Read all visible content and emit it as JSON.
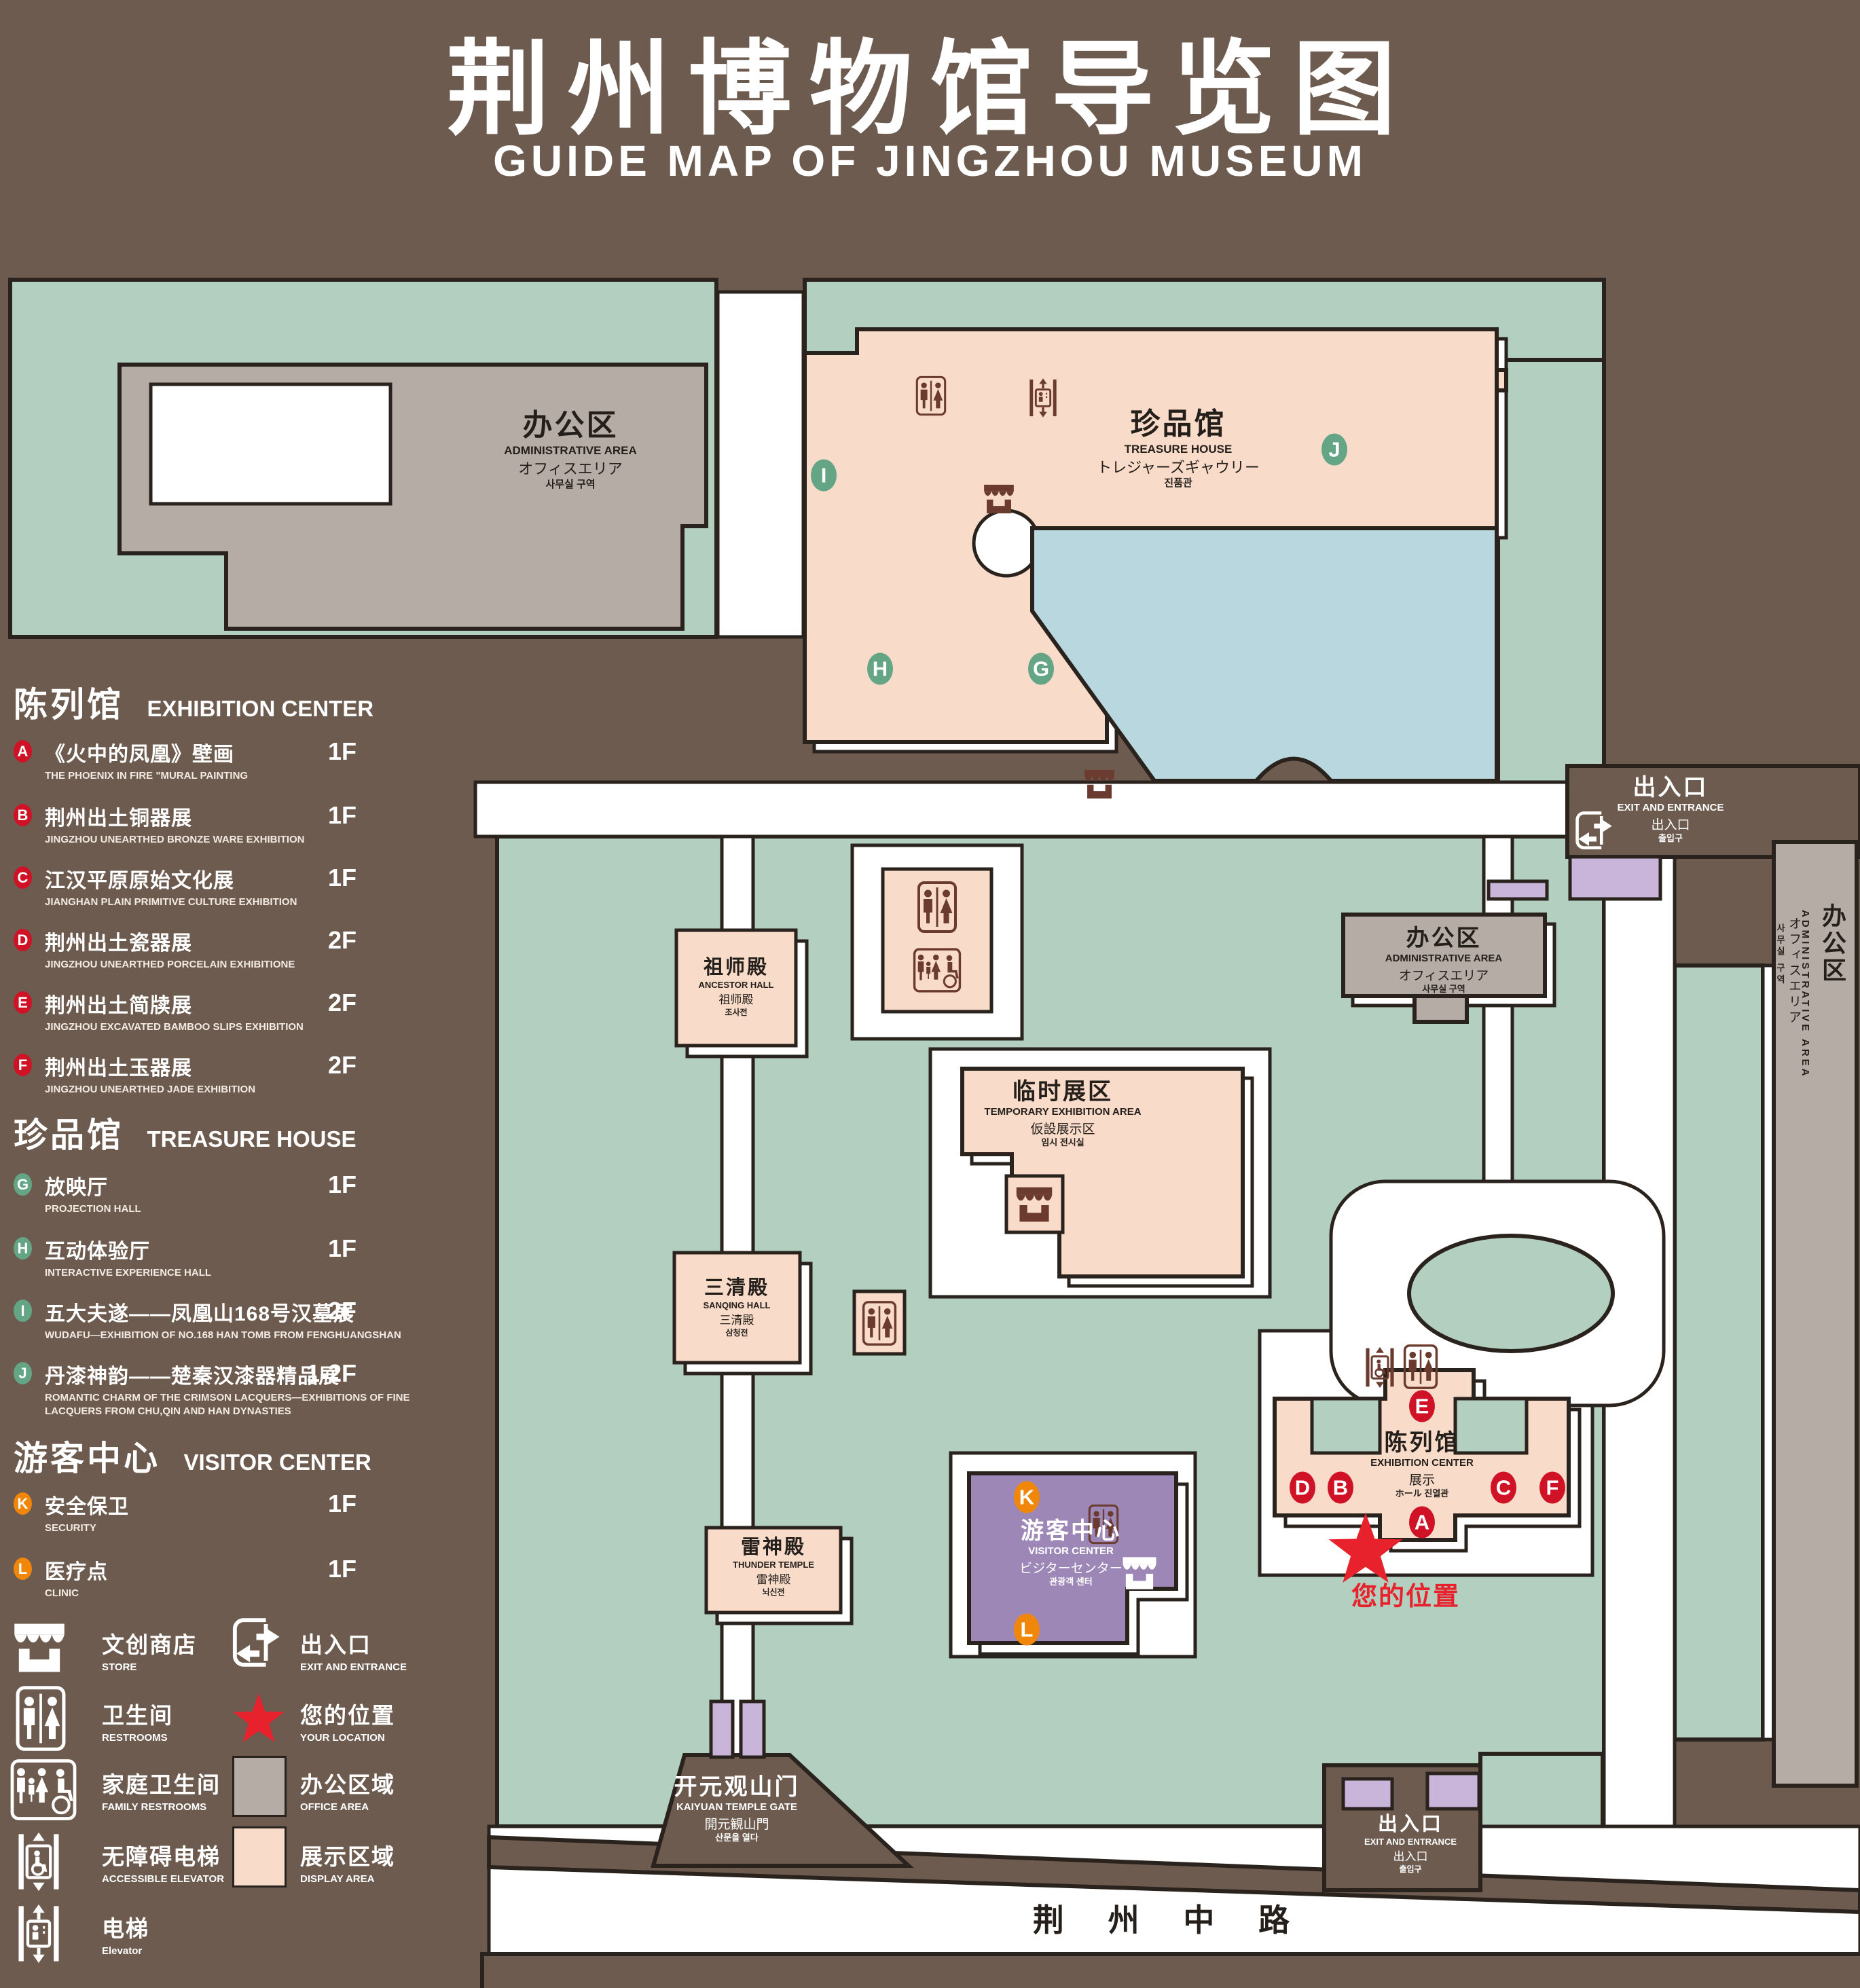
{
  "title": {
    "zh": "荆州博物馆导览图",
    "en": "GUIDE MAP OF JINGZHOU MUSEUM"
  },
  "colors": {
    "background": "#6d5b4f",
    "green_area": "#b3cfc0",
    "display_area": "#f9dbc9",
    "office_area": "#b5aca6",
    "visitor_center": "#9c87b7",
    "gate_accent": "#c8b5d9",
    "water": "#b9d7de",
    "outline": "#2a221d",
    "marker_red": "#cf1225",
    "marker_green": "#63a585",
    "marker_orange": "#f0860a",
    "location_red": "#e8222d"
  },
  "legend": {
    "sections": [
      {
        "zh": "陈列馆",
        "en": "EXHIBITION CENTER",
        "items": [
          {
            "id": "A",
            "zh": "《火中的凤凰》壁画",
            "en": "THE PHOENIX IN FIRE \"MURAL PAINTING",
            "floor": "1F"
          },
          {
            "id": "B",
            "zh": "荆州出土铜器展",
            "en": "JINGZHOU UNEARTHED BRONZE WARE EXHIBITION",
            "floor": "1F"
          },
          {
            "id": "C",
            "zh": "江汉平原原始文化展",
            "en": "JIANGHAN PLAIN PRIMITIVE CULTURE EXHIBITION",
            "floor": "1F"
          },
          {
            "id": "D",
            "zh": "荆州出土瓷器展",
            "en": "JINGZHOU UNEARTHED PORCELAIN EXHIBITIONE",
            "floor": "2F"
          },
          {
            "id": "E",
            "zh": "荆州出土简牍展",
            "en": "JINGZHOU EXCAVATED BAMBOO SLIPS EXHIBITION",
            "floor": "2F"
          },
          {
            "id": "F",
            "zh": "荆州出土玉器展",
            "en": "JINGZHOU UNEARTHED JADE EXHIBITION",
            "floor": "2F"
          }
        ]
      },
      {
        "zh": "珍品馆",
        "en": "TREASURE HOUSE",
        "items": [
          {
            "id": "G",
            "zh": "放映厅",
            "en": "PROJECTION HALL",
            "floor": "1F"
          },
          {
            "id": "H",
            "zh": "互动体验厅",
            "en": "INTERACTIVE EXPERIENCE HALL",
            "floor": "1F"
          },
          {
            "id": "I",
            "zh": "五大夫遂——凤凰山168号汉墓展",
            "en": "WUDAFU—EXHIBITION OF NO.168 HAN TOMB FROM FENGHUANGSHAN",
            "floor": "2F"
          },
          {
            "id": "J",
            "zh": "丹漆神韵——楚秦汉漆器精品展",
            "en": "ROMANTIC CHARM OF THE CRIMSON LACQUERS—EXHIBITIONS OF FINE LACQUERS FROM CHU,QIN AND HAN DYNASTIES",
            "floor": "1-2F"
          }
        ]
      },
      {
        "zh": "游客中心",
        "en": "VISITOR CENTER",
        "items": [
          {
            "id": "K",
            "zh": "安全保卫",
            "en": "SECURITY",
            "floor": "1F"
          },
          {
            "id": "L",
            "zh": "医疗点",
            "en": "CLINIC",
            "floor": "1F"
          }
        ]
      }
    ],
    "symbols": [
      {
        "icon": "store-icon",
        "zh": "文创商店",
        "en": "STORE"
      },
      {
        "icon": "exit-icon",
        "zh": "出入口",
        "en": "EXIT AND ENTRANCE"
      },
      {
        "icon": "restroom-icon",
        "zh": "卫生间",
        "en": "RESTROOMS"
      },
      {
        "icon": "your-location-star-icon",
        "zh": "您的位置",
        "en": "YOUR LOCATION"
      },
      {
        "icon": "family-restroom-icon",
        "zh": "家庭卫生间",
        "en": "FAMILY RESTROOMS"
      },
      {
        "icon": "office-area-swatch",
        "zh": "办公区域",
        "en": "OFFICE AREA"
      },
      {
        "icon": "accessible-elevator-icon",
        "zh": "无障碍电梯",
        "en": "ACCESSIBLE ELEVATOR"
      },
      {
        "icon": "display-area-swatch",
        "zh": "展示区域",
        "en": "DISPLAY AREA"
      },
      {
        "icon": "elevator-icon",
        "zh": "电梯",
        "en": "Elevator"
      }
    ]
  },
  "map": {
    "buildings": {
      "admin_nw": {
        "zh": "办公区",
        "en": "ADMINISTRATIVE AREA",
        "ja": "オフィスエリア",
        "ko": "사무실 구역"
      },
      "treasure_house": {
        "zh": "珍品馆",
        "en": "TREASURE HOUSE",
        "ja": "トレジャーズギャウリー",
        "ko": "진품관"
      },
      "ancestor_hall": {
        "zh": "祖师殿",
        "en": "ANCESTOR HALL",
        "ja": "祖师殿",
        "ko": "조사전"
      },
      "temporary_exhibition": {
        "zh": "临时展区",
        "en": "TEMPORARY EXHIBITION AREA",
        "ja": "仮設展示区",
        "ko": "임시 전시실"
      },
      "sanqing_hall": {
        "zh": "三清殿",
        "en": "SANQING HALL",
        "ja": "三清殿",
        "ko": "삼청전"
      },
      "thunder_temple": {
        "zh": "雷神殿",
        "en": "THUNDER TEMPLE",
        "ja": "雷神殿",
        "ko": "뇌신전"
      },
      "admin_e": {
        "zh": "办公区",
        "en": "ADMINISTRATIVE AREA",
        "ja": "オフィスエリア",
        "ko": "사무실 구역"
      },
      "admin_strip": {
        "zh": "办公区",
        "en": "ADMINISTRATIVE AREA",
        "ja": "オフィスエリア",
        "ko": "사무실 구역"
      },
      "exhibition_center": {
        "zh": "陈列馆",
        "en": "EXHIBITION CENTER",
        "ja": "展示",
        "ko": "ホール 진열관"
      },
      "visitor_center": {
        "zh": "游客中心",
        "en": "VISITOR CENTER",
        "ja": "ビジターセンター",
        "ko": "관광객 센터"
      }
    },
    "exits": {
      "ne": {
        "zh": "出入口",
        "en": "EXIT AND ENTRANCE",
        "ja": "出入口",
        "ko": "출입구"
      },
      "s": {
        "zh": "出入口",
        "en": "EXIT AND ENTRANCE",
        "ja": "出入口",
        "ko": "출입구"
      }
    },
    "gate": {
      "zh": "开元观山门",
      "en": "KAIYUAN TEMPLE GATE",
      "ja": "開元観山門",
      "ko": "산문을 열다"
    },
    "road": "荆 州 中 路",
    "your_location": "您的位置",
    "markers": {
      "A": "A",
      "B": "B",
      "C": "C",
      "D": "D",
      "E": "E",
      "F": "F",
      "G": "G",
      "H": "H",
      "I": "I",
      "J": "J",
      "K": "K",
      "L": "L"
    }
  }
}
